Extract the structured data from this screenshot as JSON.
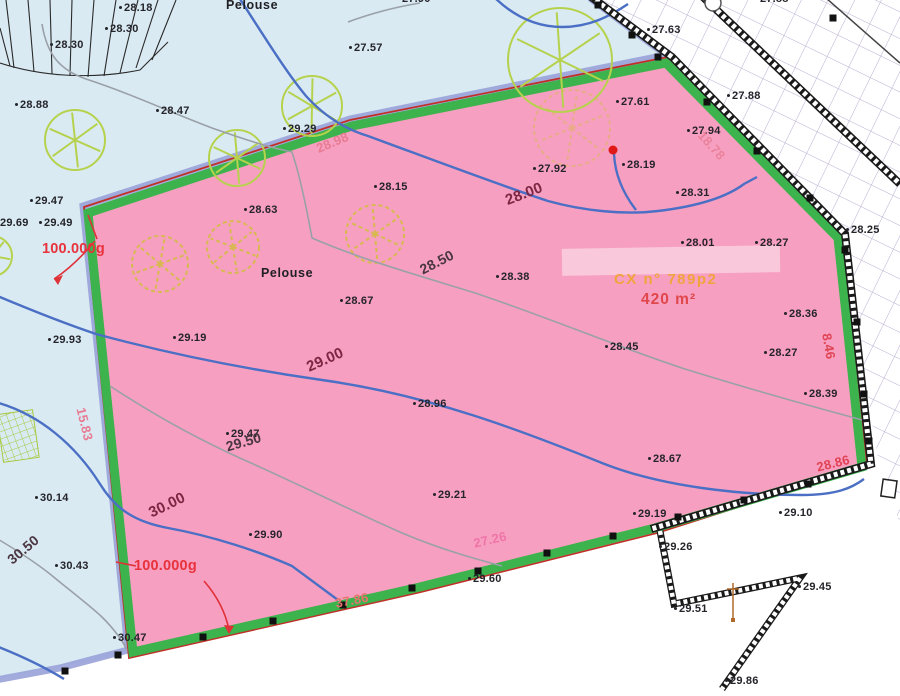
{
  "map": {
    "parcel": {
      "id_label": "CX n° 789p2",
      "area_label": "420 m²",
      "surface_label": "Pelouse"
    },
    "palette": {
      "lawn": "#d9eaf3",
      "parcel_pink": "#f79fc1",
      "border_green": "#3cb34c",
      "border_red": "#c03028",
      "band_lavender": "#98a2d8",
      "contour_blue": "#4b6fc4",
      "contour_gray": "#9aa0a8",
      "hatch_line": "#b9aed2",
      "tree_lime": "#b6d24d",
      "tree_khaki": "#d8b850",
      "red_point": "#e01818",
      "id_orange": "#f0a43c",
      "area_red": "#e0474b"
    },
    "labels": [
      {
        "t": "Pelouse",
        "x": 226,
        "y": -2,
        "c": "pel"
      },
      {
        "t": "28.18",
        "x": 124,
        "y": 2,
        "c": "spot"
      },
      {
        "t": "27.90",
        "x": 402,
        "y": -7,
        "c": "spot"
      },
      {
        "t": "28.30",
        "x": 110,
        "y": 23,
        "c": "spot"
      },
      {
        "t": "28.30",
        "x": 55,
        "y": 39,
        "c": "spot"
      },
      {
        "t": "27.57",
        "x": 354,
        "y": 42,
        "c": "spot"
      },
      {
        "t": "27.63",
        "x": 652,
        "y": 24,
        "c": "spot"
      },
      {
        "t": "27.88",
        "x": 760,
        "y": -7,
        "c": "spot"
      },
      {
        "t": "27.88",
        "x": 732,
        "y": 90,
        "c": "spot"
      },
      {
        "t": "28.88",
        "x": 20,
        "y": 99,
        "c": "spot"
      },
      {
        "t": "28.47",
        "x": 161,
        "y": 105,
        "c": "spot"
      },
      {
        "t": "27.94",
        "x": 692,
        "y": 125,
        "c": "spot"
      },
      {
        "t": "27.61",
        "x": 621,
        "y": 96,
        "c": "spot"
      },
      {
        "t": "27.92",
        "x": 538,
        "y": 163,
        "c": "spot"
      },
      {
        "t": "28.19",
        "x": 627,
        "y": 159,
        "c": "spot"
      },
      {
        "t": "28.31",
        "x": 681,
        "y": 187,
        "c": "spot"
      },
      {
        "t": "28.15",
        "x": 379,
        "y": 181,
        "c": "spot"
      },
      {
        "t": "29.29",
        "x": 288,
        "y": 123,
        "c": "spot"
      },
      {
        "t": "28.25",
        "x": 851,
        "y": 224,
        "c": "spot"
      },
      {
        "t": "29.47",
        "x": 35,
        "y": 195,
        "c": "spot"
      },
      {
        "t": "29.69",
        "x": 0,
        "y": 217,
        "c": "spot"
      },
      {
        "t": "29.49",
        "x": 44,
        "y": 217,
        "c": "spot"
      },
      {
        "t": "28.63",
        "x": 249,
        "y": 204,
        "c": "spot"
      },
      {
        "t": "Pelouse",
        "x": 261,
        "y": 266,
        "c": "pel"
      },
      {
        "t": "28.67",
        "x": 345,
        "y": 295,
        "c": "spot"
      },
      {
        "t": "28.38",
        "x": 501,
        "y": 271,
        "c": "spot"
      },
      {
        "t": "28.01",
        "x": 686,
        "y": 237,
        "c": "spot"
      },
      {
        "t": "28.27",
        "x": 760,
        "y": 237,
        "c": "spot"
      },
      {
        "t": "28.36",
        "x": 789,
        "y": 308,
        "c": "spot"
      },
      {
        "t": "28.27",
        "x": 769,
        "y": 347,
        "c": "spot"
      },
      {
        "t": "28.45",
        "x": 610,
        "y": 341,
        "c": "spot"
      },
      {
        "t": "28.39",
        "x": 809,
        "y": 388,
        "c": "spot"
      },
      {
        "t": "29.93",
        "x": 53,
        "y": 334,
        "c": "spot"
      },
      {
        "t": "29.19",
        "x": 178,
        "y": 332,
        "c": "spot"
      },
      {
        "t": "28.96",
        "x": 418,
        "y": 398,
        "c": "spot"
      },
      {
        "t": "30.14",
        "x": 40,
        "y": 492,
        "c": "spot"
      },
      {
        "t": "30.43",
        "x": 60,
        "y": 560,
        "c": "spot"
      },
      {
        "t": "29.47",
        "x": 231,
        "y": 428,
        "c": "spot"
      },
      {
        "t": "29.21",
        "x": 438,
        "y": 489,
        "c": "spot"
      },
      {
        "t": "29.90",
        "x": 254,
        "y": 529,
        "c": "spot"
      },
      {
        "t": "28.67",
        "x": 653,
        "y": 453,
        "c": "spot"
      },
      {
        "t": "29.60",
        "x": 473,
        "y": 573,
        "c": "spot"
      },
      {
        "t": "29.10",
        "x": 784,
        "y": 507,
        "c": "spot"
      },
      {
        "t": "29.19",
        "x": 638,
        "y": 508,
        "c": "spot"
      },
      {
        "t": "29.26",
        "x": 664,
        "y": 541,
        "c": "spot"
      },
      {
        "t": "29.51",
        "x": 679,
        "y": 603,
        "c": "spot"
      },
      {
        "t": "29.45",
        "x": 803,
        "y": 581,
        "c": "spot"
      },
      {
        "t": "29.86",
        "x": 730,
        "y": 675,
        "c": "spot"
      },
      {
        "t": "30.47",
        "x": 118,
        "y": 632,
        "c": "spot"
      },
      {
        "t": "28.00",
        "x": 503,
        "y": 193,
        "c": "cb",
        "r": -21
      },
      {
        "t": "29.00",
        "x": 304,
        "y": 360,
        "c": "cb",
        "r": -24
      },
      {
        "t": "30.00",
        "x": 146,
        "y": 506,
        "c": "cb",
        "r": -26
      },
      {
        "t": "28.50",
        "x": 417,
        "y": 263,
        "c": "cg",
        "r": -27
      },
      {
        "t": "29.50",
        "x": 224,
        "y": 439,
        "c": "cg",
        "r": -16
      },
      {
        "t": "30.50",
        "x": 4,
        "y": 555,
        "c": "cg",
        "r": -40
      },
      {
        "t": "28.98",
        "x": 314,
        "y": 142,
        "c": "len p1",
        "r": -23
      },
      {
        "t": "15.83",
        "x": 88,
        "y": 406,
        "c": "len p1",
        "r": 76
      },
      {
        "t": "18.78",
        "x": 706,
        "y": 128,
        "c": "len p1 faint",
        "r": 48
      },
      {
        "t": "8.46",
        "x": 834,
        "y": 332,
        "c": "len p2",
        "r": 80
      },
      {
        "t": "28.86",
        "x": 815,
        "y": 460,
        "c": "len p2",
        "r": -14
      },
      {
        "t": "37.86",
        "x": 334,
        "y": 596,
        "c": "len p3",
        "r": -11
      },
      {
        "t": "27.26",
        "x": 472,
        "y": 536,
        "c": "len p4",
        "r": -13
      },
      {
        "t": "100.000g",
        "x": 42,
        "y": 241,
        "c": "ang"
      },
      {
        "t": "100.000g",
        "x": 134,
        "y": 558,
        "c": "ang"
      },
      {
        "t": "CX n° 789p2",
        "x": 614,
        "y": 271,
        "c": "cx"
      },
      {
        "t": "420 m²",
        "x": 641,
        "y": 291,
        "c": "area"
      }
    ],
    "trees": [
      {
        "x": 75,
        "y": 140,
        "r": 30,
        "k": "lime"
      },
      {
        "x": 237,
        "y": 158,
        "r": 28,
        "k": "lime"
      },
      {
        "x": 312,
        "y": 106,
        "r": 30,
        "k": "lime"
      },
      {
        "x": 560,
        "y": 60,
        "r": 52,
        "k": "lime"
      },
      {
        "x": -8,
        "y": 256,
        "r": 20,
        "k": "lime"
      },
      {
        "x": 160,
        "y": 264,
        "r": 28,
        "k": "khaki"
      },
      {
        "x": 233,
        "y": 247,
        "r": 26,
        "k": "khaki"
      },
      {
        "x": 375,
        "y": 234,
        "r": 29,
        "k": "khaki"
      },
      {
        "x": 572,
        "y": 128,
        "r": 38,
        "k": "khaki",
        "o": 0.5
      }
    ],
    "boundary_squares": [
      [
        598,
        5
      ],
      [
        632,
        35
      ],
      [
        658,
        57
      ],
      [
        707,
        102
      ],
      [
        757,
        151
      ],
      [
        810,
        198
      ],
      [
        845,
        250
      ],
      [
        857,
        322
      ],
      [
        864,
        394
      ],
      [
        869,
        441
      ],
      [
        203,
        637
      ],
      [
        273,
        621
      ],
      [
        343,
        605
      ],
      [
        412,
        588
      ],
      [
        478,
        571
      ],
      [
        547,
        553
      ],
      [
        613,
        536
      ],
      [
        678,
        517
      ],
      [
        744,
        500
      ],
      [
        808,
        484
      ],
      [
        65,
        671
      ],
      [
        118,
        655
      ],
      [
        833,
        18
      ]
    ]
  }
}
